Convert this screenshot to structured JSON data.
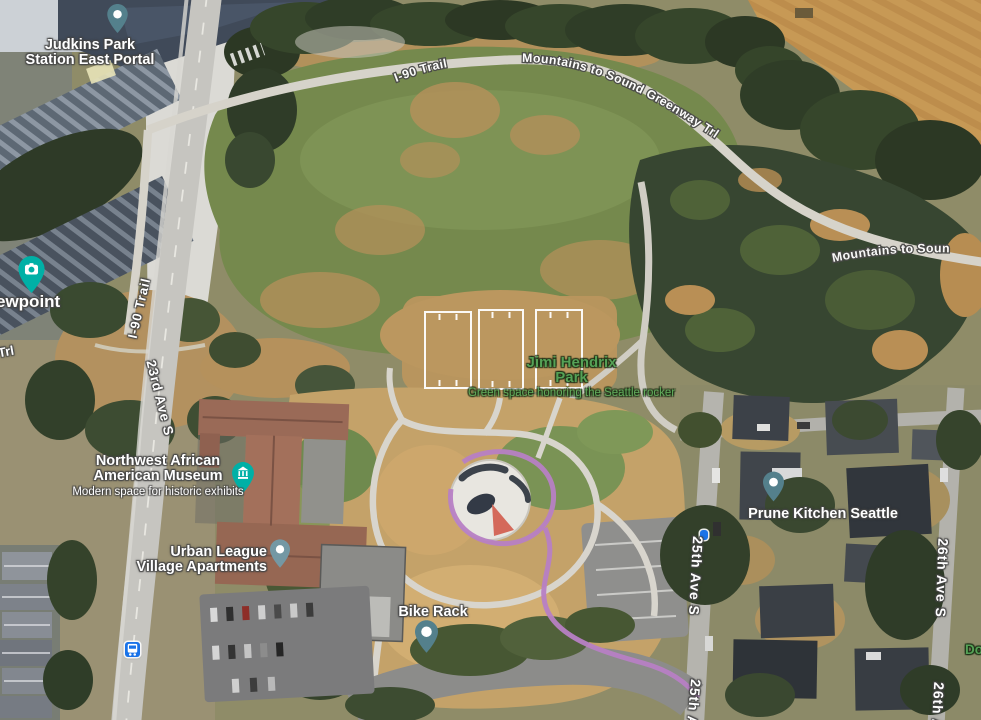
{
  "colors": {
    "label_white": "#ffffff",
    "park_green": "#55a156",
    "park_green_sub": "#61ac5b",
    "pin_teal": "#00b0a6",
    "pin_slate": "#54808c",
    "pin_gray": "#7498a4",
    "transit_blue": "#1a73e8",
    "court_line": "#ffffff",
    "ribbon_purple": "#b77fc4"
  },
  "labels": {
    "station_line1": "Judkins Park",
    "station_line2": "Station East Portal",
    "trail_i90_top": "I-90 Trail",
    "trail_mts_top": "Mountains to Sound Greenway Trl",
    "trail_mts_right": "Mountains to Soun",
    "viewpoint_partial": "ewpoint",
    "trail_trl_partial": "Trl",
    "trail_i90_left": "I-90 Trail",
    "street_23rd": "23rd Ave S",
    "street_25th": "25th Ave S",
    "street_25th_partial": "25th A",
    "street_26th": "26th Ave S",
    "street_26th_partial": "26th A",
    "park_title_line1": "Jimi Hendrix",
    "park_title_line2": "Park",
    "park_subtitle": "Green space honoring the Seattle rocker",
    "museum_line1": "Northwest African",
    "museum_line2": "American Museum",
    "museum_subtitle": "Modern space for historic exhibits",
    "apartments_line1": "Urban League",
    "apartments_line2": "Village Apartments",
    "bike_rack": "Bike Rack",
    "restaurant": "Prune Kitchen Seattle",
    "park_partial": "Do"
  }
}
